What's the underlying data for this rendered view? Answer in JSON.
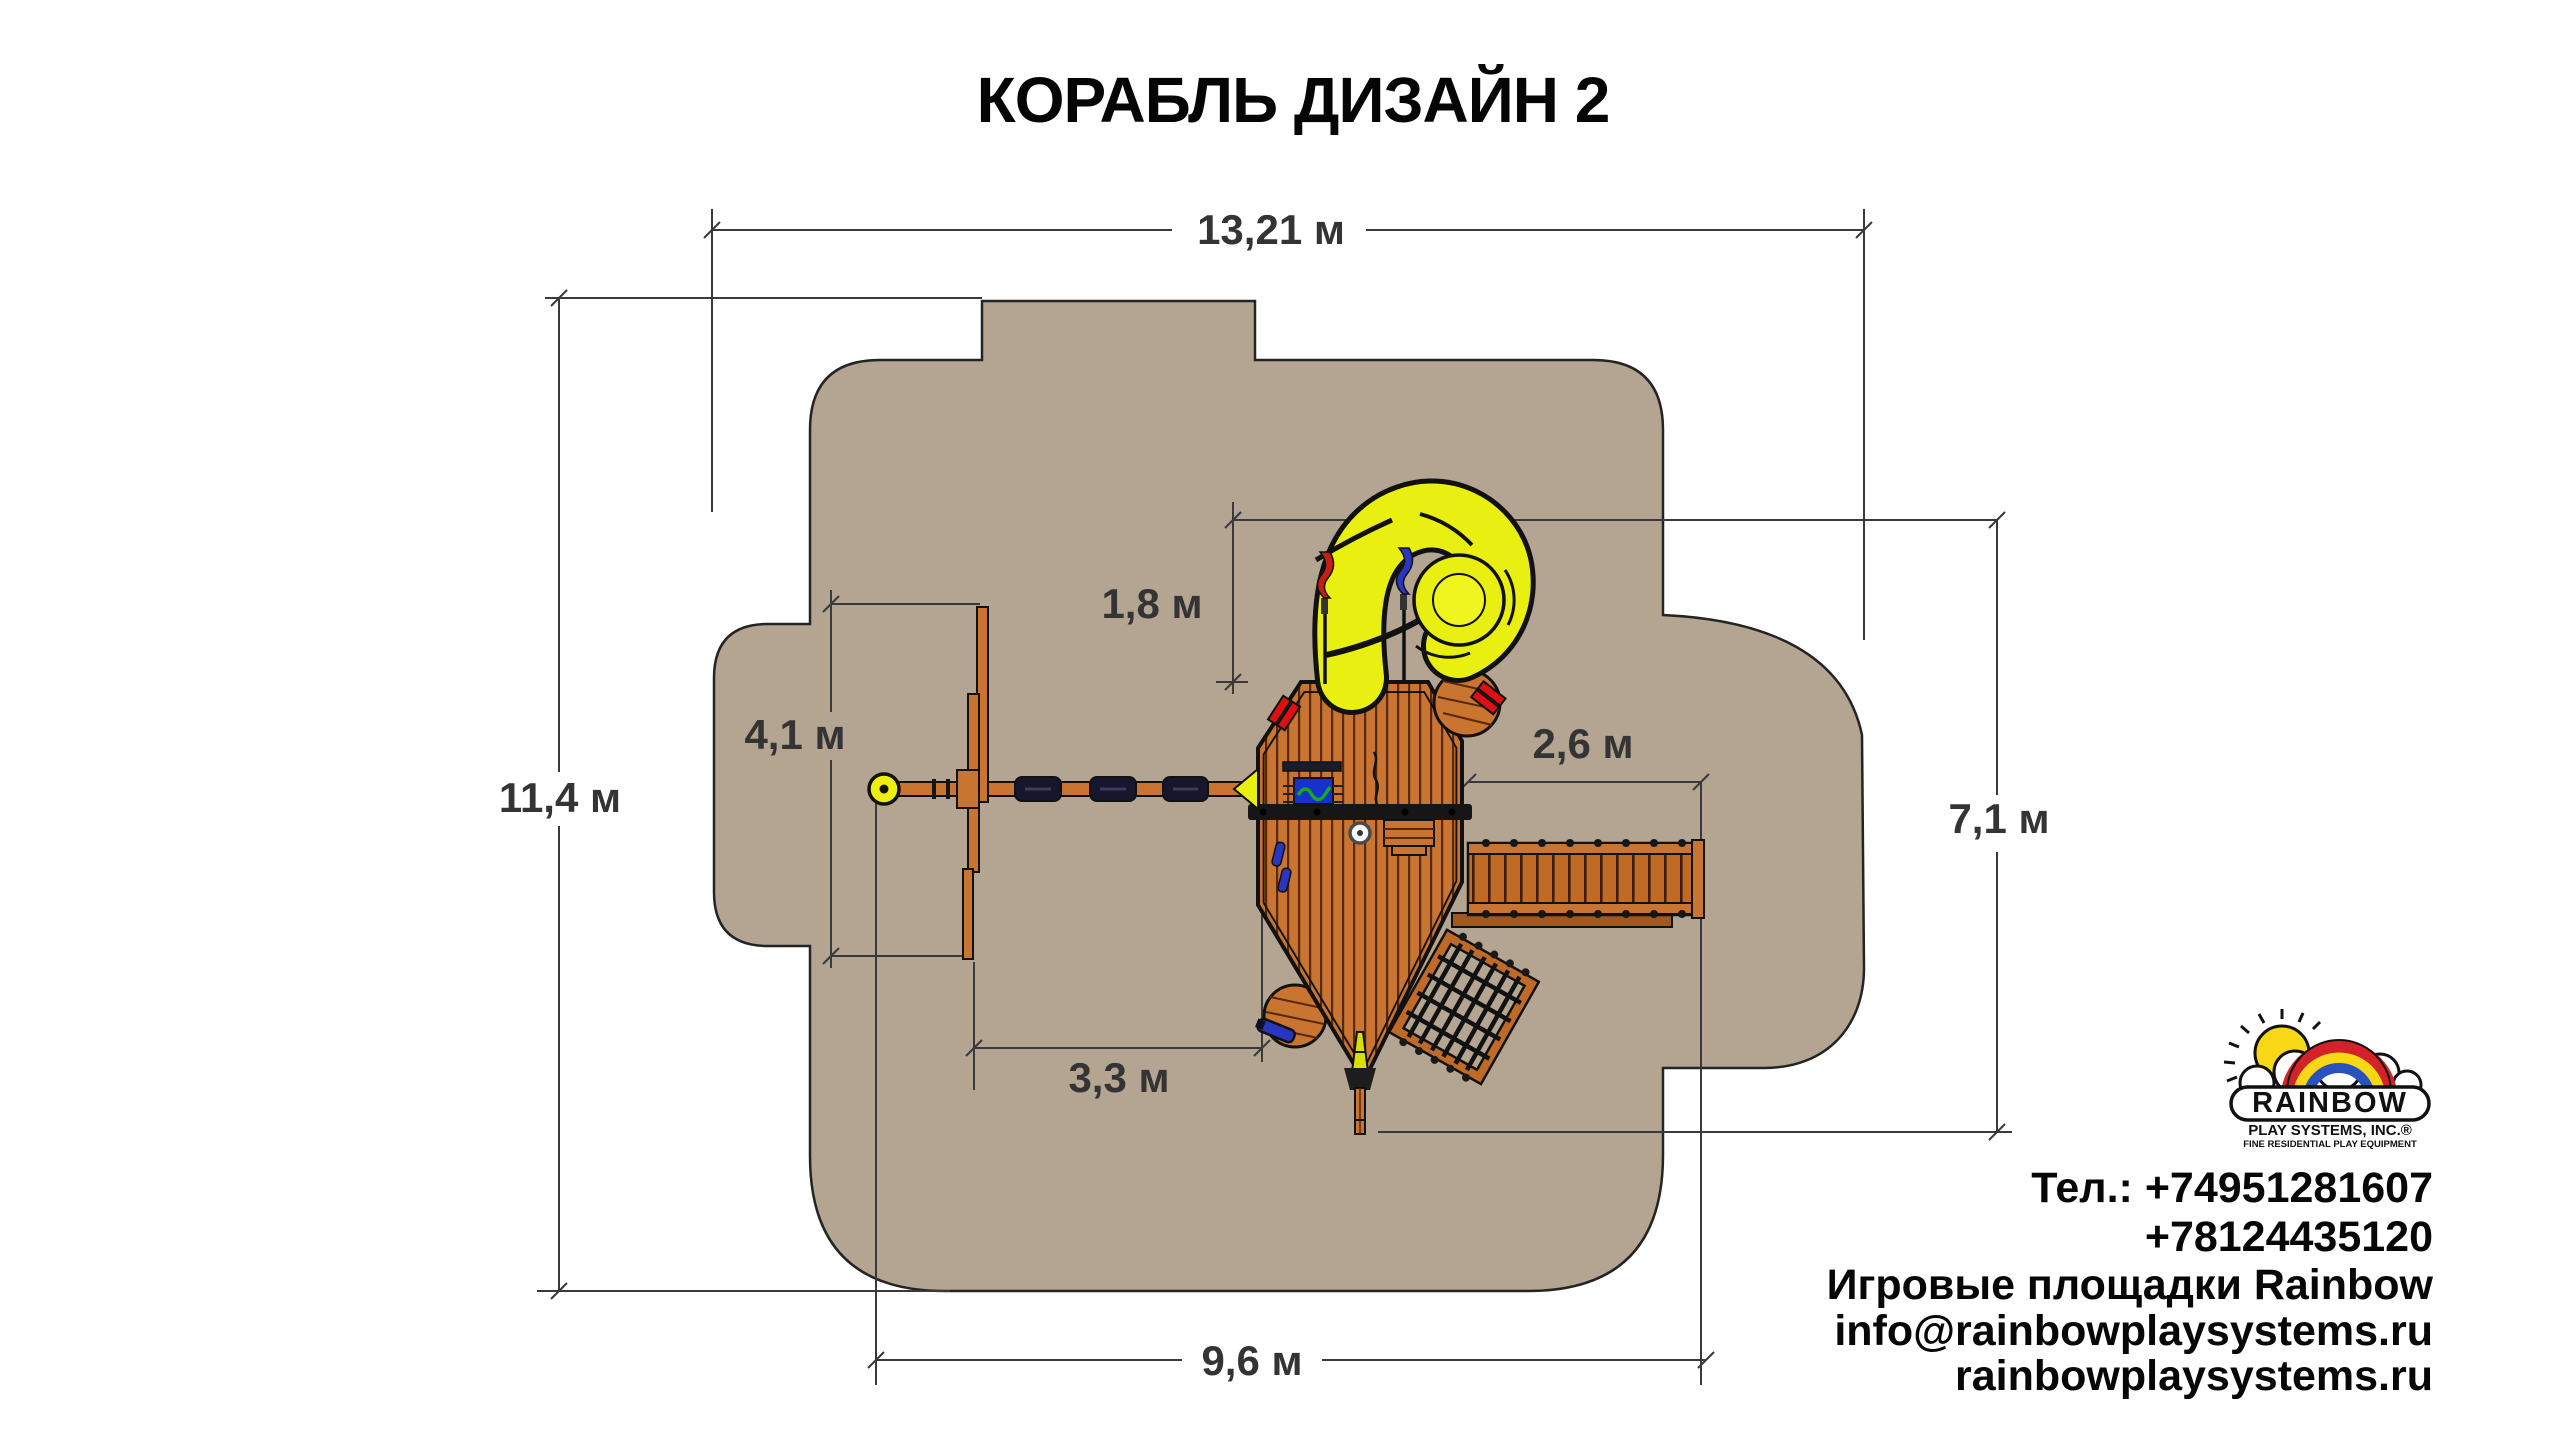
{
  "title": "КОРАБЛЬ ДИЗАЙН 2",
  "dimensions": {
    "total_width": "13,21 м",
    "total_depth": "11,4 м",
    "slide_clearance": "1,8 м",
    "swing_wall_span": "4,1 м",
    "bridge_span": "2,6 м",
    "right_depth": "7,1 м",
    "swing_to_ship": "3,3 м",
    "equipment_width": "9,6 м"
  },
  "logo": {
    "brand": "RAINBOW",
    "subtitle": "PLAY SYSTEMS, INC.®",
    "tagline": "FINE RESIDENTIAL PLAY EQUIPMENT"
  },
  "contacts": {
    "phone_line1": "Тел.: +74951281607",
    "phone_line2": "+78124435120",
    "company": "Игровые площадки Rainbow",
    "email": "info@rainbowplaysystems.ru",
    "website": "rainbowplaysystems.ru"
  },
  "colors": {
    "safety_zone": "#b4a492",
    "wood": "#c97431",
    "wood_dark": "#a05820",
    "slide_yellow": "#e9ef10",
    "accent_red": "#dd1111",
    "accent_blue": "#2a35c0",
    "dimension_line": "#3a3a3a",
    "logo_red": "#d3222a",
    "logo_yellow": "#f7d716",
    "logo_blue": "#2a52be"
  }
}
